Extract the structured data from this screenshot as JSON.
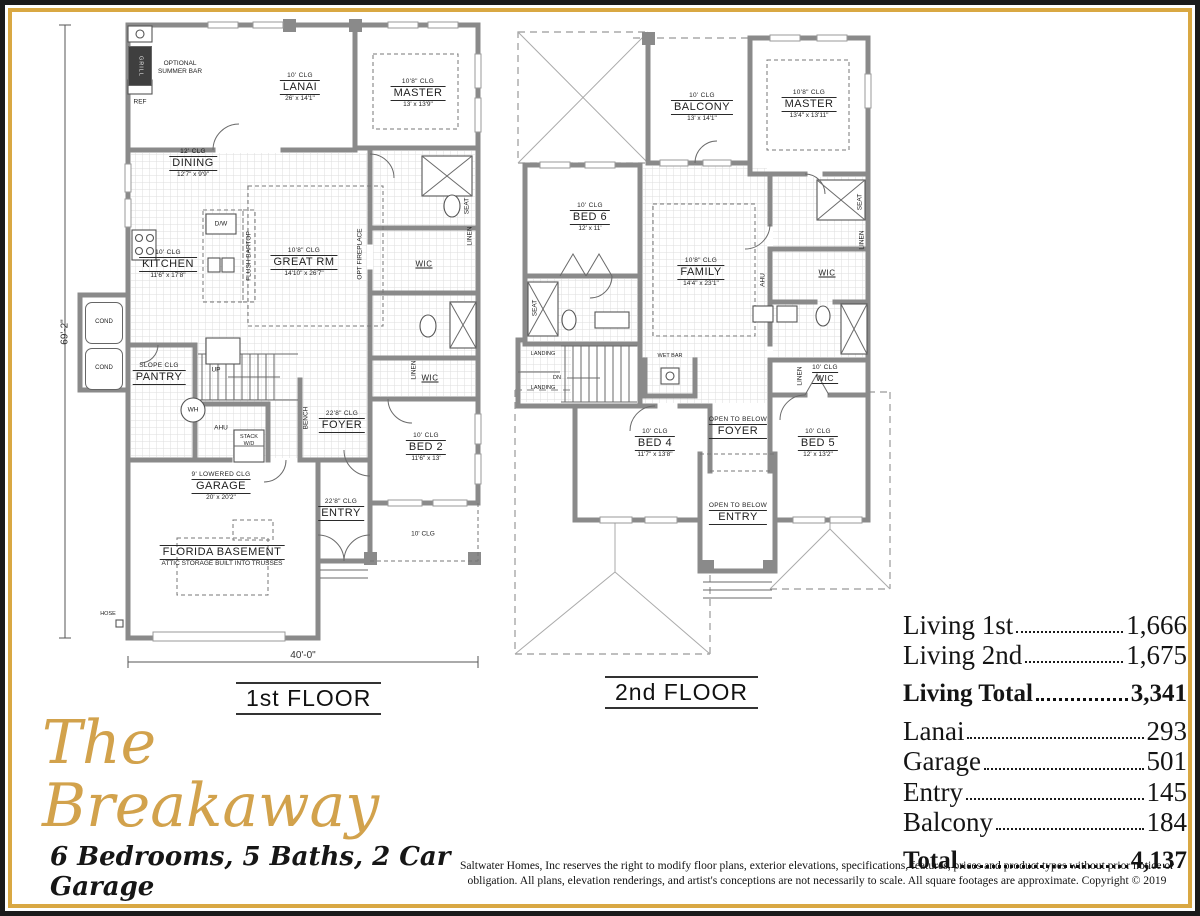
{
  "colors": {
    "gold_border": "#d9a843",
    "black_border": "#1b1b1b",
    "wall_gray": "#8a8a8a",
    "title_gold": "#d2a24c"
  },
  "brand": {
    "title": "The Breakaway",
    "subtitle": "6 Bedrooms, 5 Baths, 2 Car Garage"
  },
  "floor1": {
    "label": "1st FLOOR",
    "dim_width": "40'-0\"",
    "dim_height": "69'-2\"",
    "rooms": {
      "lanai": {
        "clg": "10' CLG",
        "name": "LANAI",
        "dims": "26' x 14'1\""
      },
      "master": {
        "clg": "10'8\" CLG",
        "name": "MASTER",
        "dims": "13' x 13'9\""
      },
      "dining": {
        "clg": "12' CLG",
        "name": "DINING",
        "dims": "12'7\" x 9'9\""
      },
      "kitchen": {
        "clg": "10' CLG",
        "name": "KITCHEN",
        "dims": "11'6\" x 17'8\""
      },
      "great_rm": {
        "clg": "10'8\" CLG",
        "name": "GREAT RM",
        "dims": "14'10\" x 26'7\""
      },
      "pantry": {
        "clg": "SLOPE CLG",
        "name": "PANTRY"
      },
      "foyer": {
        "clg": "22'8\" CLG",
        "name": "FOYER"
      },
      "bed2": {
        "clg": "10' CLG",
        "name": "BED 2",
        "dims": "11'6\" x 13'"
      },
      "garage": {
        "clg": "9' LOWERED CLG",
        "name": "GARAGE",
        "dims": "20' x 20'2\""
      },
      "entry": {
        "clg": "22'8\" CLG",
        "name": "ENTRY"
      },
      "porch": {
        "clg": "10' CLG"
      },
      "basement": {
        "name": "FLORIDA BASEMENT",
        "sub": "ATTIC STORAGE BUILT INTO TRUSSES"
      }
    },
    "small": {
      "optional_summer_bar": "OPTIONAL SUMMER BAR",
      "grill": "GRILL",
      "ref": "REF",
      "dw": "D/W",
      "flush_bartop": "FLUSH BARTOP",
      "opt_fireplace": "OPT FIREPLACE",
      "wic": "WIC",
      "linen": "LINEN",
      "seat": "SEAT",
      "up": "UP",
      "wh": "WH",
      "ahu": "AHU",
      "stack_wd": "STACK W/D",
      "bench": "BENCH",
      "cond": "COND",
      "hose": "HOSE"
    }
  },
  "floor2": {
    "label": "2nd FLOOR",
    "rooms": {
      "balcony": {
        "clg": "10' CLG",
        "name": "BALCONY",
        "dims": "13' x 14'1\""
      },
      "master": {
        "clg": "10'8\" CLG",
        "name": "MASTER",
        "dims": "13'4\" x 13'11\""
      },
      "bed6": {
        "clg": "10' CLG",
        "name": "BED 6",
        "dims": "12' x 11'"
      },
      "family": {
        "clg": "10'8\" CLG",
        "name": "FAMILY",
        "dims": "14'4\" x 23'1\""
      },
      "bed4": {
        "clg": "10' CLG",
        "name": "BED 4",
        "dims": "11'7\" x 13'8\""
      },
      "bed5": {
        "clg": "10' CLG",
        "name": "BED 5",
        "dims": "12' x 13'2\""
      },
      "foyer": {
        "clg": "OPEN TO BELOW",
        "name": "FOYER"
      },
      "entry": {
        "clg": "OPEN TO BELOW",
        "name": "ENTRY"
      },
      "wic_bed5": {
        "clg": "10' CLG",
        "name": "WIC"
      }
    },
    "small": {
      "wic": "WIC",
      "ahu": "AHU",
      "seat": "SEAT",
      "linen": "LINEN",
      "landing": "LANDING",
      "dn": "DN",
      "wet_bar": "WET BAR"
    }
  },
  "stats": {
    "rows": [
      {
        "label": "Living 1st",
        "value": "1,666"
      },
      {
        "label": "Living 2nd",
        "value": "1,675"
      },
      {
        "label": "Living Total",
        "value": "3,341"
      },
      {
        "label": "Lanai",
        "value": "293"
      },
      {
        "label": "Garage",
        "value": "501"
      },
      {
        "label": "Entry",
        "value": "145"
      },
      {
        "label": "Balcony",
        "value": "184"
      },
      {
        "label": "Total",
        "value": "4,137"
      }
    ]
  },
  "disclaimer": "Saltwater Homes, Inc reserves the right to modify floor plans, exterior elevations, specifications, features, prices and product types without prior notice or obligation. All plans, elevation renderings, and artist's conceptions are not necessarily to scale. All square footages are approximate. Copyright © 2019"
}
